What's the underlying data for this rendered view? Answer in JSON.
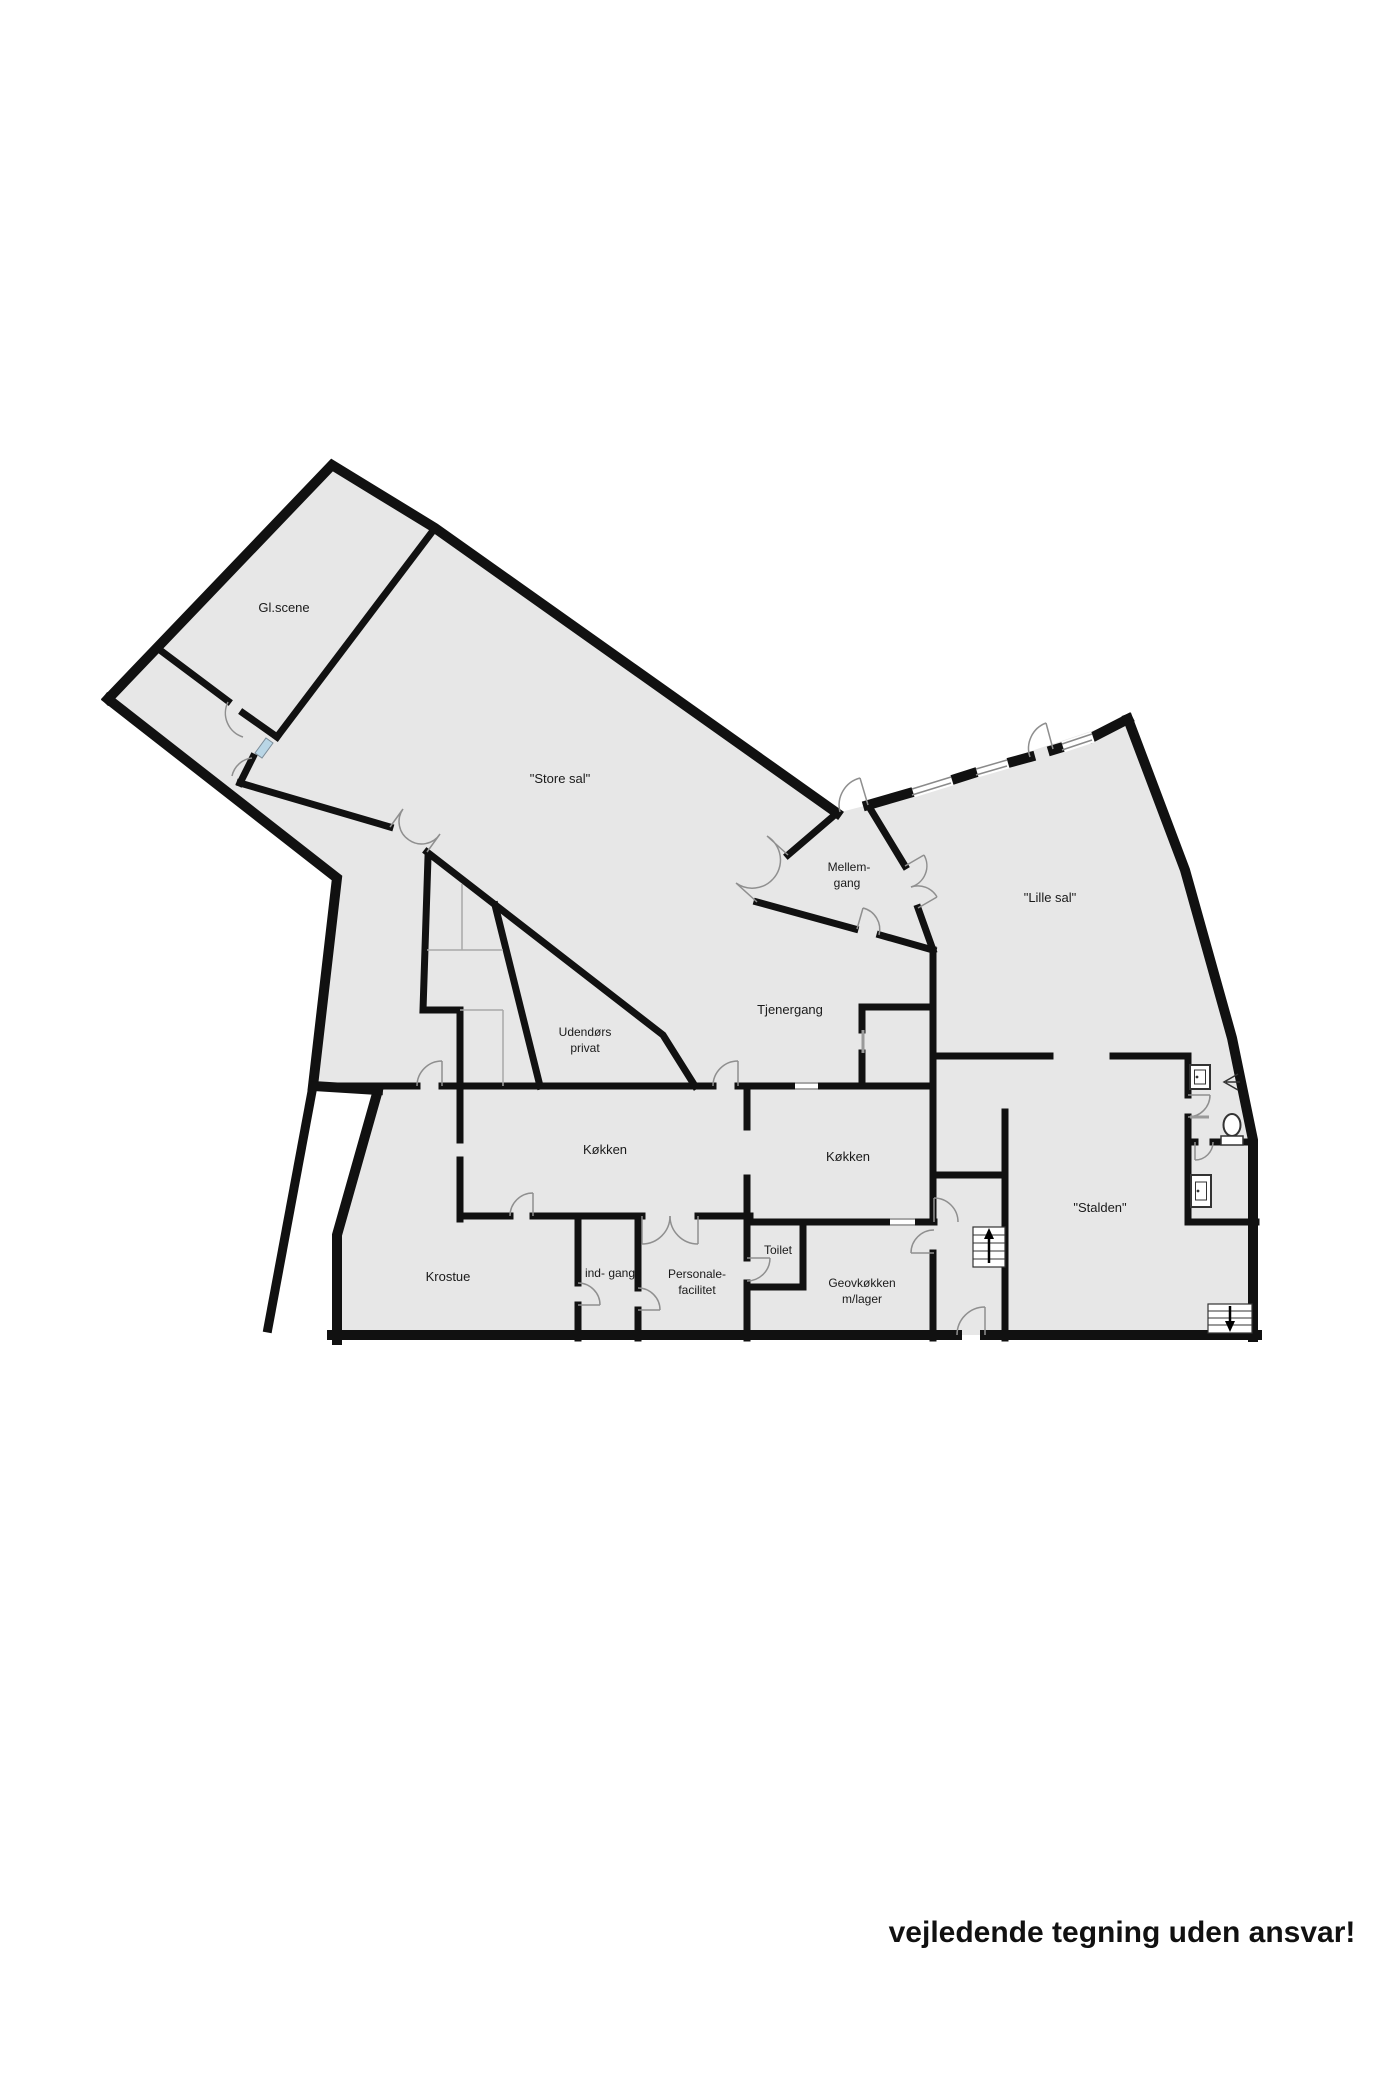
{
  "plan": {
    "title": "Floor plan (stueplan)",
    "disclaimer": "vejledende tegning uden ansvar!",
    "colors": {
      "floor": "#e7e7e7",
      "wall": "#111111",
      "door_arc": "#8f8f8f",
      "thin_partition": "#a8a8a8",
      "window_marker_blue": "#b9d6e6",
      "fixture_stroke": "#333333"
    },
    "rooms": [
      {
        "id": "gl-scene",
        "label": "Gl.scene"
      },
      {
        "id": "store-sal",
        "label": "\"Store sal\""
      },
      {
        "id": "mellemgang",
        "lines": [
          "Mellem-",
          "gang"
        ]
      },
      {
        "id": "lille-sal",
        "label": "\"Lille sal\""
      },
      {
        "id": "tjenergang",
        "label": "Tjenergang"
      },
      {
        "id": "udendors-privat",
        "lines": [
          "Udendørs",
          "privat"
        ]
      },
      {
        "id": "kokken-vest",
        "label": "Køkken"
      },
      {
        "id": "kokken-ost",
        "label": "Køkken"
      },
      {
        "id": "stalden",
        "label": "\"Stalden\""
      },
      {
        "id": "krostue",
        "label": "Krostue"
      },
      {
        "id": "indgang",
        "label": "ind- gang"
      },
      {
        "id": "personale",
        "lines": [
          "Personale-",
          "facilitet"
        ]
      },
      {
        "id": "toilet",
        "label": "Toilet"
      },
      {
        "id": "geovkokken",
        "lines": [
          "Geovkøkken",
          "m/lager"
        ]
      }
    ],
    "fixtures": [
      {
        "id": "sink-upper-bath",
        "name": "washbasin"
      },
      {
        "id": "sink-lower-bath",
        "name": "washbasin"
      },
      {
        "id": "toilet-bowl",
        "name": "toilet"
      },
      {
        "id": "shower-head",
        "name": "shower"
      },
      {
        "id": "stairs-up",
        "name": "staircase-up"
      },
      {
        "id": "stairs-down",
        "name": "staircase-down"
      },
      {
        "id": "window-blue",
        "name": "window-marker"
      }
    ]
  }
}
